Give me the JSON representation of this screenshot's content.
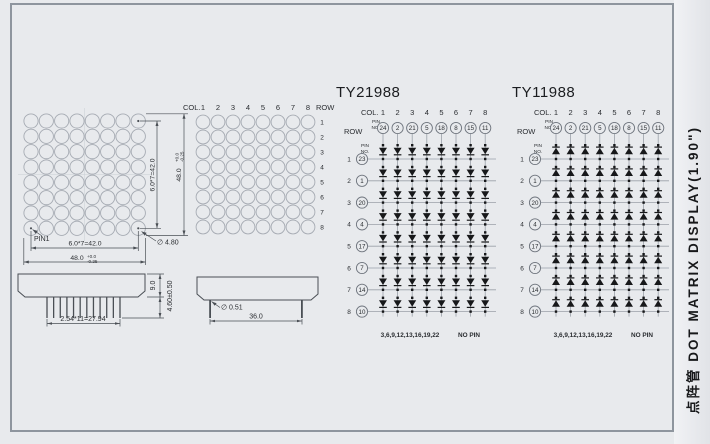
{
  "side_strip": {
    "label": "点阵管 DOT MATRIX DISPLAY(1.90\")"
  },
  "front_view": {
    "rows": 8,
    "cols": 8,
    "pin1": "PIN1",
    "led_diameter": "∅ 4.80",
    "dim_inner_h": "6.0*7=42.0",
    "dim_outer_h": "48.0",
    "dim_inner_v": "6.0*7=42.0",
    "dim_outer_v": "48.0",
    "tol_top": "+0.0",
    "tol_bottom": "-0.25"
  },
  "pixel_map": {
    "col_label": "COL.",
    "row_label": "ROW",
    "col_numbers": [
      "1",
      "2",
      "3",
      "4",
      "5",
      "6",
      "7",
      "8"
    ],
    "row_numbers": [
      "1",
      "2",
      "3",
      "4",
      "5",
      "6",
      "7",
      "8"
    ]
  },
  "circuits": [
    {
      "title": "TY21988",
      "col_label": "COL.",
      "row_label": "ROW",
      "pin_label_top": "PIN",
      "pin_label_bottom": "NO.",
      "col_numbers": [
        "1",
        "2",
        "3",
        "4",
        "5",
        "6",
        "7",
        "8"
      ],
      "col_pins": [
        "24",
        "2",
        "21",
        "5",
        "18",
        "8",
        "15",
        "11"
      ],
      "row_numbers": [
        "1",
        "2",
        "3",
        "4",
        "5",
        "6",
        "7",
        "8"
      ],
      "row_pins": [
        "23",
        "1",
        "20",
        "4",
        "17",
        "7",
        "14",
        "10"
      ],
      "diode_direction": "down",
      "no_pin_list": "3,6,9,12,13,16,19,22",
      "no_pin_label": "NO PIN"
    },
    {
      "title": "TY11988",
      "col_label": "COL.",
      "row_label": "ROW",
      "pin_label_top": "PIN",
      "pin_label_bottom": "NO.",
      "col_numbers": [
        "1",
        "2",
        "3",
        "4",
        "5",
        "6",
        "7",
        "8"
      ],
      "col_pins": [
        "24",
        "2",
        "21",
        "5",
        "18",
        "8",
        "15",
        "11"
      ],
      "row_numbers": [
        "1",
        "2",
        "3",
        "4",
        "5",
        "6",
        "7",
        "8"
      ],
      "row_pins": [
        "23",
        "1",
        "20",
        "4",
        "17",
        "7",
        "14",
        "10"
      ],
      "diode_direction": "up",
      "no_pin_list": "3,6,9,12,13,16,19,22",
      "no_pin_label": "NO PIN"
    }
  ],
  "side_view_front": {
    "pin_count": 12,
    "pin_pitch_dim": "2.54*11=27.94",
    "body_height_dim": "9.0",
    "pin_length_dim": "4.60±0.50"
  },
  "side_view_side": {
    "pin_diameter": "∅ 0.51",
    "pin_span_dim": "36.0"
  },
  "colors": {
    "background": "#e8eaed",
    "frame_border": "#8e959e",
    "drawing_line": "#4a4f55",
    "grid_line": "#9aa0a8",
    "diode": "#17181a",
    "led_outline": "#a6abb3",
    "pin_circle": "#6f757e",
    "text": "#2a2d31",
    "muted_text": "#90959d",
    "faint_text": "#b9bec5"
  }
}
